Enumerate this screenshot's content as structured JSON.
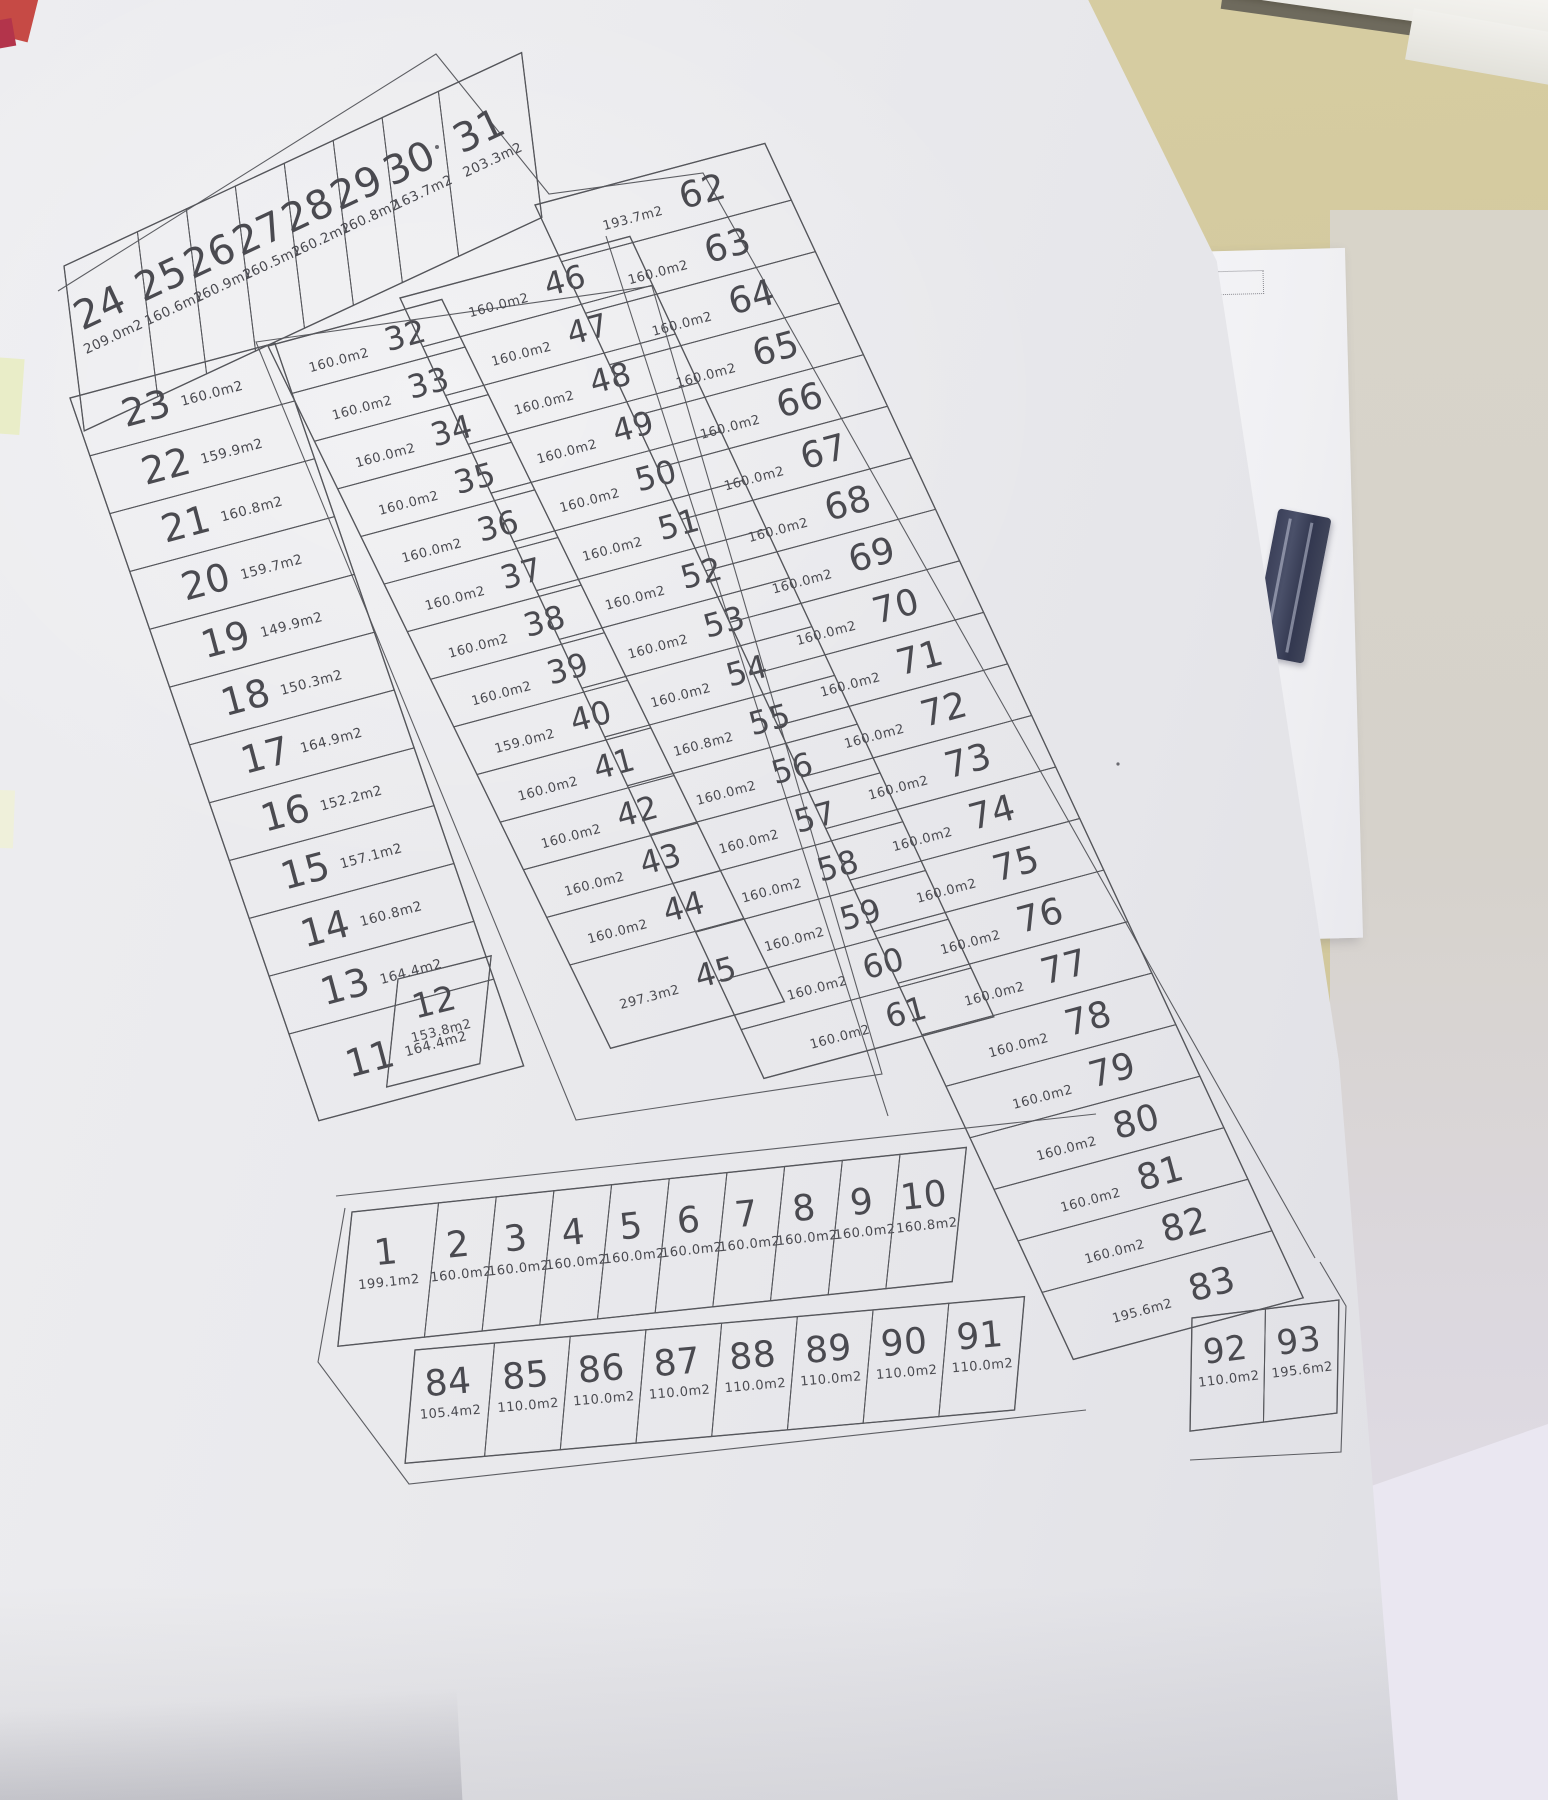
{
  "photo": {
    "desk_color": "#d5cb9f",
    "paper_color": "#e9e9ed",
    "drawing_line_color": "#55565b",
    "drawing_text_color": "#4a4a50",
    "white_sheet_color": "#f3f3f6",
    "lavender_sheet_color": "#eae7f1",
    "navy_ruler_color": "#3f4459"
  },
  "plan": {
    "strips": [
      {
        "id": "fan-24-31",
        "lots": [
          {
            "n": "24",
            "a": "209.0m2"
          },
          {
            "n": "25",
            "a": "160.6m2"
          },
          {
            "n": "26",
            "a": "160.9m2"
          },
          {
            "n": "27",
            "a": "160.5m2"
          },
          {
            "n": "28",
            "a": "160.2m2"
          },
          {
            "n": "29",
            "a": "160.8m2"
          },
          {
            "n": "30",
            "a": "163.7m2"
          },
          {
            "n": "31",
            "a": "203.3m2"
          }
        ]
      },
      {
        "id": "left-col-23-11",
        "lots": [
          {
            "n": "23",
            "a": "160.0m2"
          },
          {
            "n": "22",
            "a": "159.9m2"
          },
          {
            "n": "21",
            "a": "160.8m2"
          },
          {
            "n": "20",
            "a": "159.7m2"
          },
          {
            "n": "19",
            "a": "149.9m2"
          },
          {
            "n": "18",
            "a": "150.3m2"
          },
          {
            "n": "17",
            "a": "164.9m2"
          },
          {
            "n": "16",
            "a": "152.2m2"
          },
          {
            "n": "15",
            "a": "157.1m2"
          },
          {
            "n": "14",
            "a": "160.8m2"
          },
          {
            "n": "13",
            "a": "164.4m2"
          },
          {
            "n": "11",
            "a": "164.4m2"
          }
        ]
      },
      {
        "id": "lot-12",
        "lots": [
          {
            "n": "12",
            "a": "153.8m2"
          }
        ]
      },
      {
        "id": "mid-left-col-32-45",
        "lots": [
          {
            "n": "32",
            "a": "160.0m2"
          },
          {
            "n": "33",
            "a": "160.0m2"
          },
          {
            "n": "34",
            "a": "160.0m2"
          },
          {
            "n": "35",
            "a": "160.0m2"
          },
          {
            "n": "36",
            "a": "160.0m2"
          },
          {
            "n": "37",
            "a": "160.0m2"
          },
          {
            "n": "38",
            "a": "160.0m2"
          },
          {
            "n": "39",
            "a": "160.0m2"
          },
          {
            "n": "40",
            "a": "159.0m2"
          },
          {
            "n": "41",
            "a": "160.0m2"
          },
          {
            "n": "42",
            "a": "160.0m2"
          },
          {
            "n": "43",
            "a": "160.0m2"
          },
          {
            "n": "44",
            "a": "160.0m2"
          },
          {
            "n": "45",
            "a": "297.3m2"
          }
        ]
      },
      {
        "id": "mid-right-col-46-61",
        "lots": [
          {
            "n": "46",
            "a": "160.0m2"
          },
          {
            "n": "47",
            "a": "160.0m2"
          },
          {
            "n": "48",
            "a": "160.0m2"
          },
          {
            "n": "49",
            "a": "160.0m2"
          },
          {
            "n": "50",
            "a": "160.0m2"
          },
          {
            "n": "51",
            "a": "160.0m2"
          },
          {
            "n": "52",
            "a": "160.0m2"
          },
          {
            "n": "53",
            "a": "160.0m2"
          },
          {
            "n": "54",
            "a": "160.0m2"
          },
          {
            "n": "55",
            "a": "160.8m2"
          },
          {
            "n": "56",
            "a": "160.0m2"
          },
          {
            "n": "57",
            "a": "160.0m2"
          },
          {
            "n": "58",
            "a": "160.0m2"
          },
          {
            "n": "59",
            "a": "160.0m2"
          },
          {
            "n": "60",
            "a": "160.0m2"
          },
          {
            "n": "61",
            "a": "160.0m2"
          }
        ]
      },
      {
        "id": "right-col-62-83",
        "lots": [
          {
            "n": "62",
            "a": "193.7m2"
          },
          {
            "n": "63",
            "a": "160.0m2"
          },
          {
            "n": "64",
            "a": "160.0m2"
          },
          {
            "n": "65",
            "a": "160.0m2"
          },
          {
            "n": "66",
            "a": "160.0m2"
          },
          {
            "n": "67",
            "a": "160.0m2"
          },
          {
            "n": "68",
            "a": "160.0m2"
          },
          {
            "n": "69",
            "a": "160.0m2"
          },
          {
            "n": "70",
            "a": "160.0m2"
          },
          {
            "n": "71",
            "a": "160.0m2"
          },
          {
            "n": "72",
            "a": "160.0m2"
          },
          {
            "n": "73",
            "a": "160.0m2"
          },
          {
            "n": "74",
            "a": "160.0m2"
          },
          {
            "n": "75",
            "a": "160.0m2"
          },
          {
            "n": "76",
            "a": "160.0m2"
          },
          {
            "n": "77",
            "a": "160.0m2"
          },
          {
            "n": "78",
            "a": "160.0m2"
          },
          {
            "n": "79",
            "a": "160.0m2"
          },
          {
            "n": "80",
            "a": "160.0m2"
          },
          {
            "n": "81",
            "a": "160.0m2"
          },
          {
            "n": "82",
            "a": "160.0m2"
          },
          {
            "n": "83",
            "a": "195.6m2"
          }
        ]
      },
      {
        "id": "row-1-10",
        "lots": [
          {
            "n": "1",
            "a": "199.1m2"
          },
          {
            "n": "2",
            "a": "160.0m2"
          },
          {
            "n": "3",
            "a": "160.0m2"
          },
          {
            "n": "4",
            "a": "160.0m2"
          },
          {
            "n": "5",
            "a": "160.0m2"
          },
          {
            "n": "6",
            "a": "160.0m2"
          },
          {
            "n": "7",
            "a": "160.0m2"
          },
          {
            "n": "8",
            "a": "160.0m2"
          },
          {
            "n": "9",
            "a": "160.0m2"
          },
          {
            "n": "10",
            "a": "160.8m2"
          }
        ]
      },
      {
        "id": "row-84-91",
        "lots": [
          {
            "n": "84",
            "a": "105.4m2"
          },
          {
            "n": "85",
            "a": "110.0m2"
          },
          {
            "n": "86",
            "a": "110.0m2"
          },
          {
            "n": "87",
            "a": "110.0m2"
          },
          {
            "n": "88",
            "a": "110.0m2"
          },
          {
            "n": "89",
            "a": "110.0m2"
          },
          {
            "n": "90",
            "a": "110.0m2"
          },
          {
            "n": "91",
            "a": "110.0m2"
          }
        ]
      },
      {
        "id": "row-92-93",
        "lots": [
          {
            "n": "92",
            "a": "110.0m2"
          },
          {
            "n": "93",
            "a": "195.6m2"
          }
        ]
      }
    ]
  }
}
